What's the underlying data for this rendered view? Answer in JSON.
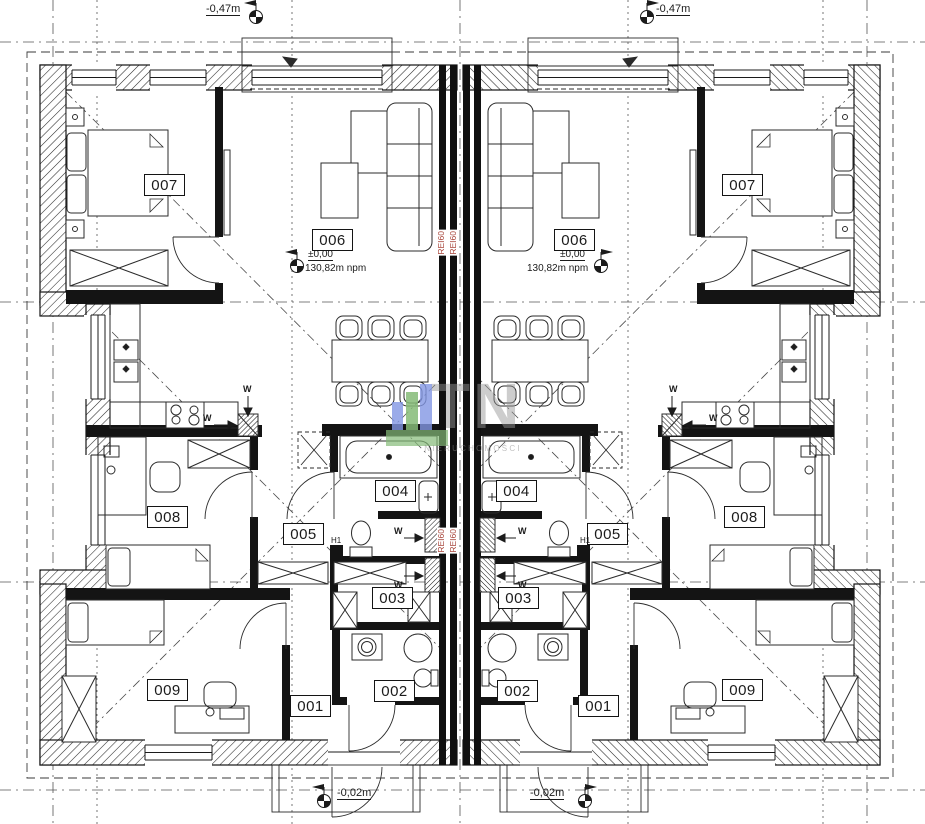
{
  "drawing": {
    "type": "duplex-floor-plan",
    "units": 2,
    "mirrored": true
  },
  "rooms": {
    "entry": "001",
    "wc": "002",
    "storage": "003",
    "bathroom": "004",
    "hall": "005",
    "living": "006",
    "bedroom_main": "007",
    "bedroom_small": "008",
    "bedroom_rear": "009"
  },
  "levels": {
    "street": "-0,47m",
    "porch": "-0,02m",
    "floor": "±0,00",
    "elevation": "130,82m npm"
  },
  "fire": {
    "rating": "REI60",
    "color": "#a8453a"
  },
  "vents": {
    "label": "W",
    "h1": "H1"
  },
  "watermark": {
    "initials": "TN",
    "caption": "NIERUCHOMOŚCI",
    "bar_blue": "#8296e3",
    "bar_green": "#85bb77"
  },
  "colors": {
    "line": "#1b1b1b",
    "axis": "#444444"
  }
}
